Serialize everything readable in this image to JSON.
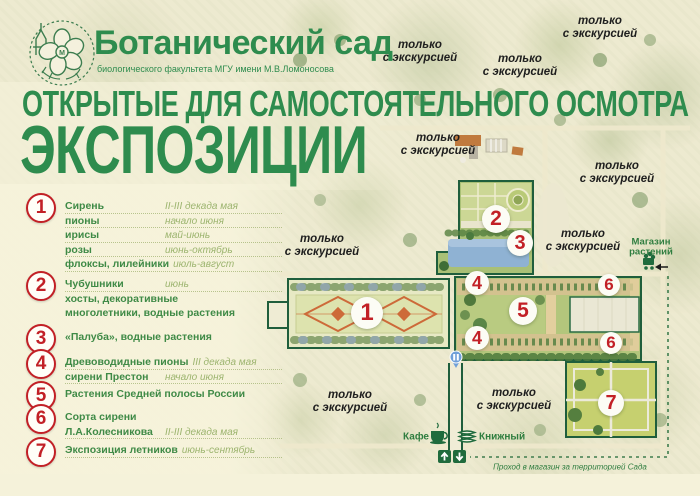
{
  "header": {
    "title": "Ботанический сад",
    "subtitle": "биологического факультета МГУ имени М.В.Ломоносова",
    "headline_line1": "ОТКРЫТЫЕ ДЛЯ САМОСТОЯТЕЛЬНОГО ОСМОТРА",
    "headline_line2": "ЭКСПОЗИЦИИ"
  },
  "legend": {
    "items": [
      {
        "number": "1",
        "rows": [
          {
            "name": "Сирень",
            "value": "II-III декада мая"
          },
          {
            "name": "пионы",
            "value": "начало июня"
          },
          {
            "name": "ирисы",
            "value": "май-июнь"
          },
          {
            "name": "розы",
            "value": "июнь-октябрь"
          },
          {
            "name": "флоксы, лилейники",
            "value": "июль-август"
          }
        ]
      },
      {
        "number": "2",
        "rows": [
          {
            "name": "Чубушники",
            "value": "июнь"
          },
          {
            "name": "хосты, декоративные",
            "value": ""
          },
          {
            "name": "многолетники, водные растения",
            "value": ""
          }
        ]
      },
      {
        "number": "3",
        "rows": [
          {
            "name": "«Палуба», водные растения",
            "value": ""
          }
        ]
      },
      {
        "number": "4",
        "rows": [
          {
            "name": "Древоводидные пионы",
            "value": "III декада мая"
          },
          {
            "name": "сирени Престон",
            "value": "начало июня"
          }
        ]
      },
      {
        "number": "5",
        "rows": [
          {
            "name": "Растения Средней полосы России",
            "value": ""
          }
        ]
      },
      {
        "number": "6",
        "rows": [
          {
            "name": "Сорта сирени",
            "value": ""
          },
          {
            "name": "Л.А.Колесникова",
            "value": "II-III декада мая"
          }
        ]
      },
      {
        "number": "7",
        "rows": [
          {
            "name": "Экспозиция летников",
            "value": "июнь-сентябрь"
          }
        ]
      }
    ]
  },
  "map": {
    "excursion_label_lines": [
      "только",
      "с экскурсией"
    ],
    "excursion_labels": [
      {
        "x": 420,
        "y": 52
      },
      {
        "x": 520,
        "y": 66
      },
      {
        "x": 600,
        "y": 28
      },
      {
        "x": 438,
        "y": 145
      },
      {
        "x": 617,
        "y": 173
      },
      {
        "x": 322,
        "y": 246
      },
      {
        "x": 583,
        "y": 241
      },
      {
        "x": 350,
        "y": 402
      },
      {
        "x": 514,
        "y": 400
      }
    ],
    "circles": [
      {
        "n": "1",
        "x": 367,
        "y": 313,
        "r": 16
      },
      {
        "n": "2",
        "x": 496,
        "y": 219,
        "r": 14
      },
      {
        "n": "3",
        "x": 520,
        "y": 243,
        "r": 13
      },
      {
        "n": "4",
        "x": 477,
        "y": 283,
        "r": 12
      },
      {
        "n": "5",
        "x": 523,
        "y": 311,
        "r": 14
      },
      {
        "n": "4",
        "x": 477,
        "y": 338,
        "r": 12
      },
      {
        "n": "6",
        "x": 609,
        "y": 285,
        "r": 11
      },
      {
        "n": "6",
        "x": 611,
        "y": 343,
        "r": 11
      },
      {
        "n": "7",
        "x": 611,
        "y": 403,
        "r": 13
      }
    ],
    "shop": {
      "line1": "Магазин",
      "line2": "растений"
    },
    "cafe_label": "Кафе",
    "bookstore_label": "Книжный",
    "shop_access_note": "Проход в магазин за территорией Сада"
  },
  "colors": {
    "accent_red": "#c22026",
    "brand_green": "#2e8c4e",
    "legend_value_green": "#9cb46e",
    "map_border_green": "#1f5e3c",
    "pond_blue": "#8fb2d3",
    "poi_green": "#2e7d3f"
  }
}
